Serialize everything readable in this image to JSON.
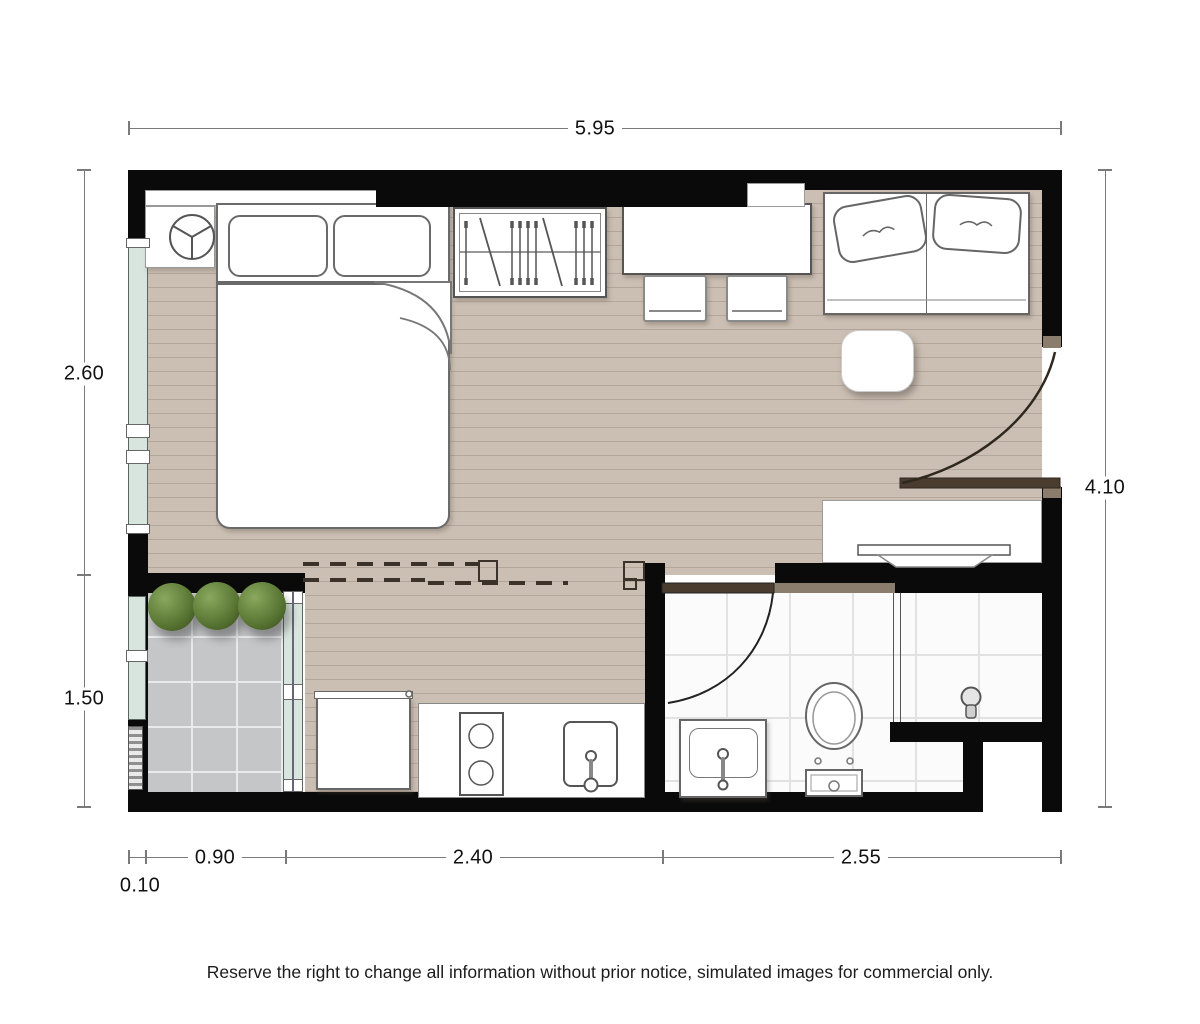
{
  "title": "Studio unit floor plan",
  "dimensions": {
    "top": "5.95",
    "left_upper": "2.60",
    "left_lower": "1.50",
    "right": "4.10",
    "bottom_offset": "0.10",
    "bottom_balcony": "0.90",
    "bottom_kitchen": "2.40",
    "bottom_bathroom": "2.55"
  },
  "disclaimer": "Reserve the right to change all information without prior notice, simulated images for commercial only.",
  "colors": {
    "wall": "#0a0a0a",
    "wood": "#cbbfb4",
    "plank": "#b4a79a",
    "tile": "#c5c6c8",
    "tileline": "#e9eaec",
    "bath": "#fbfbfb",
    "bathgrid": "#e2e2e2",
    "glass": "#d8e4de",
    "tan": "#8b7d6d",
    "leaf": "#4a3d2f",
    "dim": "#7a7a7a",
    "ink": "#111111",
    "plant1": "#8aa85e",
    "plant2": "#54702f"
  }
}
